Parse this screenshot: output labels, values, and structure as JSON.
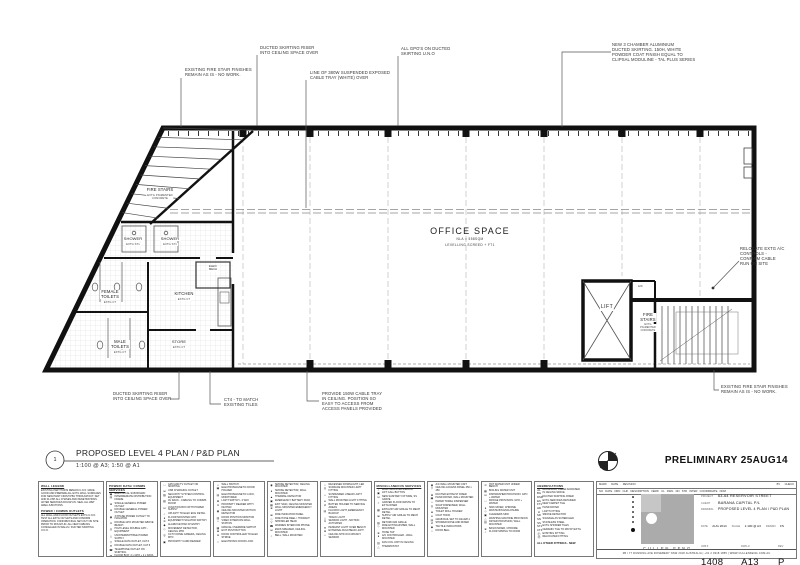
{
  "sheet": {
    "plan_number": "1",
    "plan_title": "PROPOSED LEVEL 4 PLAN / P&D PLAN",
    "plan_scale": "1:100 @ A3;  1:50 @ A1",
    "status_stamp": "PRELIMINARY 25AUG14"
  },
  "rooms": {
    "fire_stairs_left": "FIRE STAIRS",
    "fire_stairs_left_sub": "EXTG  PIGMENTED\nCONCRETE",
    "shower_1": "SHOWER",
    "shower_1_sub": "EXTG  ST1",
    "shower_2": "SHOWER",
    "shower_2_sub": "EXTG  ST1",
    "female_toilets": "FEMALE\nTOILETS",
    "female_toilets_sub": "EXTG  CT",
    "kitchen": "KITCHEN",
    "kitchen_sub": "EXTG  CT",
    "elec_mech": "ELEC/\nMECH",
    "male_toilets": "MALE\nTOILETS",
    "male_toilets_sub": "EXTG  CT",
    "store": "STORE",
    "store_sub": "EXTG  CT",
    "office": "OFFICE SPACE",
    "office_sub1": "NLA = 558SQM",
    "office_sub2": "LEVELLING  SCREED  +  FT1",
    "lift": "LIFT",
    "ac": "A/C",
    "fire_stairs_right": "FIRE\nSTAIRS",
    "fire_stairs_right_sub": "EXTG\nPIGMENTED\nCONCRETE"
  },
  "annotations": {
    "fire_stair_top": "EXISTING FIRE STAIR FINISHES\nREMAIN AS IS - NO WORK.",
    "skirting_riser_top": "DUCTED SKIRTING RISER\nINTO CEILING SPACE OVER",
    "cable_tray_line": "LINE OF 380W SUSPENDED EXPOSED\nCABLE TRAY (WHITE) OVER",
    "gpos": "ALL GPO'S ON DUCTED\nSKIRTING U.N.O",
    "new_skirting": "NEW 3 CHAMBER ALUMINIUM\nDUCTED SKIRTING. 150H, WHITE\nPOWDER COAT FINISH EQUAL TO\nCLIPSAL MODULINE - TAL PLUS SERIES",
    "relocate_ac": "RELOCATE EXTG A/C\nCONTROLS -\nCONFIRM CABLE\nRUN ON SITE",
    "skirting_riser_bottom": "DUCTED SKIRTING RISER\nINTO CEILING SPACE OVER",
    "ct4": "CT4 - TO MATCH\nEXISTING TILES",
    "cable_tray_ceiling": "PROVIDE 150W CABLE TRAY\nIN CEILING. POSITION SO\nEASY TO ACCESS FROM\nACCESS PANELS PROVIDED",
    "fire_stair_bottom": "EXISTING FIRE STAIR FINISHES\nREMAIN AS IS - NO WORK."
  },
  "legend": {
    "wall": {
      "header": "WALL LEGEND",
      "body": "EXISTING PARTITIONS REMAIN U.N.O. MAKE GOOD AND PREPARE ALL EXTG WALL SURFACES FOR NEW PAINT FINISH PB1 THROUGHOUT. SET AND FLUSH ALL CHASES AND PENETRATIONS AFTER SERVICES ROUGH-IN. SEAL ALL WET AREA JUNCTIONS.",
      "sub_header": "POWER / COMMS OUTLETS",
      "sub_body": "ALL WALL AND FLOOR OUTLETS EXTG U.N.O. TEST ALL EXTG OUTLETS AND CONFIRM OPERATION. CONFIRM FINAL SET-OUT ON SITE PRIOR TO ROUGH-IN. ALL NEW CABLING CONCEALED IN WALLS / DUCTED SKIRTING U.N.O."
    },
    "columns": [
      {
        "header": "POWER/ DATA/ COMMS SERVICES",
        "items": [
          {
            "s": "▣",
            "t": "ELECTRICAL SUB BOARD"
          },
          {
            "s": "▤",
            "t": "INTERMEDIATE DISTRIBUTION FRAME"
          },
          {
            "s": "⊕",
            "t": "SINGLE GENERAL POWER OUTLET"
          },
          {
            "s": "⊕",
            "t": "DOUBLE GENERAL POWER OUTLET"
          },
          {
            "s": "◉",
            "t": "3 PHASE POWER OUTLET TO ISOLATOR"
          },
          {
            "s": "⊙",
            "t": "DOUBLE GPO MOUNTED ABOVE BENCH"
          },
          {
            "s": "◎",
            "t": "HIGH LEVEL DOUBLE GPO - EQUIPMENT"
          },
          {
            "s": "△",
            "t": "UNINTERRUPTIBLE POWER SUPPLY"
          },
          {
            "s": "▽",
            "t": "SINGLE DATA OUTLET, CAT 6"
          },
          {
            "s": "▼",
            "t": "DOUBLE DATA OUTLET, CAT 6"
          },
          {
            "s": "☎",
            "t": "TELEPHONE OUTLET ON SKIRTING"
          },
          {
            "s": "▦",
            "t": "FLOOR BOX: 2 x GPO + 2 x DATA"
          }
        ]
      },
      {
        "header": "",
        "items": [
          {
            "s": "□",
            "t": "GPO AND TV OUTLET ON SKIRTING"
          },
          {
            "s": "⊟",
            "t": "USB CHARGING OUTLET"
          },
          {
            "s": "▧",
            "t": "SECURITY SYSTEM CONTROL EQUIPMENT"
          },
          {
            "s": "▨",
            "t": "AV RACK - CABLING TO COMMS ROOM"
          },
          {
            "s": "⊡",
            "t": "JUNCTION BOX WITH POWER SUPPLY"
          },
          {
            "s": "○",
            "t": "UPLIGHT TO ELEC ENG DETAIL"
          },
          {
            "s": "●",
            "t": "FLOOR MOUNTED GPO"
          },
          {
            "s": "⊘",
            "t": "EQUIPMENT ISOLATOR SWITCH"
          },
          {
            "s": "◆",
            "t": "ALARM KEYPAD AT ENTRY"
          },
          {
            "s": "◇",
            "t": "MOVEMENT DETECTOR, CEILING MTD"
          },
          {
            "s": "◎",
            "t": "CCTV DOME CAMERA, CEILING MTD"
          },
          {
            "s": "▣",
            "t": "PROXIMITY CARD READER"
          }
        ]
      },
      {
        "header": "",
        "items": [
          {
            "s": "□",
            "t": "WALL SWITCH"
          },
          {
            "s": "▣",
            "t": "ELECTROMAGNETIC DOOR HOLDER"
          },
          {
            "s": "▤",
            "t": "ELECTROMAGNETIC LOCK, MONITORED"
          },
          {
            "s": "⊠",
            "t": "LIGHT SWITCH - 2 WAY"
          },
          {
            "s": "⊙",
            "t": "PROXIMITY READER WITH KEYPAD"
          },
          {
            "s": "◉",
            "t": "CEILING MOUNTED MOTION DETECTOR"
          },
          {
            "s": "▥",
            "t": "DOOR POSITION MONITOR"
          },
          {
            "s": "□",
            "t": "VIDEO INTERCOM WALL STATION"
          },
          {
            "s": "▦",
            "t": "MANUAL OVERRIDE SWITCH"
          },
          {
            "s": "⊞",
            "t": "EXIT PUSH BUTTON"
          },
          {
            "s": "⊡",
            "t": "DOOR CONTROLLER TO ELEC STRIKE"
          },
          {
            "s": "≈",
            "t": "ELECTRONIC DOOR LOCK"
          }
        ]
      },
      {
        "header": "",
        "items": [
          {
            "s": "◉",
            "t": "SMOKE DETECTOR, CEILING MOUNTED"
          },
          {
            "s": "●",
            "t": "SMOKE DETECTOR, WALL MOUNTED"
          },
          {
            "s": "▲",
            "t": "THERMAL DETECTOR"
          },
          {
            "s": "▣",
            "t": "EMERGENCY BATTERY PACK"
          },
          {
            "s": "▦",
            "t": "EXIT SIGN, CEILING MOUNTED"
          },
          {
            "s": "⊕",
            "t": "WALL MOUNTED EMERGENCY LIGHT"
          },
          {
            "s": "⊞",
            "t": "FIRE INDICATOR PANEL"
          },
          {
            "s": "◇",
            "t": "FIRE HOSE REEL / HYDRANT"
          },
          {
            "s": "▽",
            "t": "SPRINKLER HEAD"
          },
          {
            "s": "☎",
            "t": "WARDEN INTERCOM PHONE"
          },
          {
            "s": "⊟",
            "t": "EWIS SPEAKER, CEILING MOUNTED"
          },
          {
            "s": "○",
            "t": "BELL, WALL MOUNTED"
          }
        ]
      },
      {
        "header": "",
        "items": [
          {
            "s": "○",
            "t": "RECESSED DOWNLIGHT, LED"
          },
          {
            "s": "◎",
            "t": "SURFACE MOUNTED LIGHT FITTING"
          },
          {
            "s": "□",
            "t": "SUSPENDED LINEAR LIGHT FITTING"
          },
          {
            "s": "●",
            "t": "WALL MOUNTED LIGHT FITTING"
          },
          {
            "s": "⊘",
            "t": "BATTEN HOLDER TO SERVICE AREAS"
          },
          {
            "s": "▤",
            "t": "FLUORO LIGHT, EMERGENCY BACKUP"
          },
          {
            "s": "△",
            "t": "TRACK LIGHT"
          },
          {
            "s": "⊙",
            "t": "SENSOR LIGHT - MOTION ACTIVATED"
          },
          {
            "s": "▼",
            "t": "PENDANT LIGHT OVER BENCH"
          },
          {
            "s": "⊕",
            "t": "EXTERNAL BULKHEAD LIGHT"
          },
          {
            "s": "□",
            "t": "CEILING MTD OCCUPANCY SENSOR"
          }
        ]
      },
      {
        "header": "MISCELLANEOUS SERVICES",
        "items": [
          {
            "s": "○",
            "t": "WALL MOUNTED MIRROR"
          },
          {
            "s": "▣",
            "t": "LIFT CALL BUTTON"
          },
          {
            "s": "⊡",
            "t": "NEW SANITARY FIXTURE, SS GRATE"
          },
          {
            "s": "≈",
            "t": "GRATED FLOOR WASTE TO EXTG RISER"
          },
          {
            "s": "▦",
            "t": "EXHAUST AIR GRILLE TO MECH DETAIL"
          },
          {
            "s": "⊞",
            "t": "SUPPLY AIR GRILLE TO MECH DETAIL"
          },
          {
            "s": "▧",
            "t": "RETURN AIR GRILLE"
          },
          {
            "s": "◇",
            "t": "FIRE EXTINGUISHER, WALL MOUNTED"
          },
          {
            "s": "⊕",
            "t": "HOSE TAP"
          },
          {
            "s": "●",
            "t": "A/C CONTROLLER - WALL MOUNTED"
          },
          {
            "s": "▥",
            "t": "FAN COIL UNIT IN CEILING"
          },
          {
            "s": "△",
            "t": "THERMOSTAT"
          }
        ]
      },
      {
        "header": "",
        "items": [
          {
            "s": "◉",
            "t": "A/C WALL MOUNTED UNIT"
          },
          {
            "s": "▽",
            "t": "CEILING ACCESS PANEL 450 x 450"
          },
          {
            "s": "⊠",
            "t": "DUCTED EXHAUST RISER"
          },
          {
            "s": "▣",
            "t": "HAND DRYER, WALL MOUNTED"
          },
          {
            "s": "□",
            "t": "PAPER TOWEL DISPENSER"
          },
          {
            "s": "◎",
            "t": "SOAP DISPENSER, WALL MOUNTED"
          },
          {
            "s": "⊟",
            "t": "TOILET ROLL HOLDER"
          },
          {
            "s": "●",
            "t": "COAT HOOK"
          },
          {
            "s": "▤",
            "t": "GRAB RAIL SET TO AS1428.1"
          },
          {
            "s": "⊘",
            "t": "SHOWER ROSE AND MIXER"
          },
          {
            "s": "◆",
            "t": "TACTILE INDICATORS"
          },
          {
            "s": "○",
            "t": "DOOR BELL"
          }
        ]
      },
      {
        "header": "",
        "items": [
          {
            "s": "⊙",
            "t": "HOT WATER UNIT UNDER BENCH"
          },
          {
            "s": "▦",
            "t": "BOILING WATER UNIT"
          },
          {
            "s": "⊡",
            "t": "DISHWASHER PROVISION: GPO + WATER"
          },
          {
            "s": "□",
            "t": "FRIDGE PROVISION: GPO + WATER"
          },
          {
            "s": "●",
            "t": "SINK MIXER, CHROME"
          },
          {
            "s": "◇",
            "t": "WASTE BIN ENCLOSURE"
          },
          {
            "s": "▣",
            "t": "CLEANERS SINK"
          },
          {
            "s": "△",
            "t": "WASHING MACHINE PROVISION"
          },
          {
            "s": "▥",
            "t": "DRYER PROVISION, WALL MOUNTED"
          },
          {
            "s": "⊕",
            "t": "BASIN MIXER, CHROME"
          },
          {
            "s": "○",
            "t": "FLOOR SPRING TO DOOR"
          }
        ]
      },
      {
        "header": "ABBREVIATIONS",
        "items": [
          {
            "s": "AL",
            "t": "ALUMINIUM, CLEAR ANODISED"
          },
          {
            "s": "BG",
            "t": "IN CEILING SPACE"
          },
          {
            "s": "DSR",
            "t": "DUCTED SKIRTING RISER"
          },
          {
            "s": "ES",
            "t": "EXTG SERVICES RETAINED"
          },
          {
            "s": "FT1",
            "t": "NEW CARPET TILE"
          },
          {
            "s": "HD",
            "t": "HAND DRYER"
          },
          {
            "s": "LI",
            "t": "LIGHT FITTING"
          },
          {
            "s": "SD",
            "t": "SMOKE DETECTOR"
          },
          {
            "s": "SN",
            "t": "SIGNAGE AS SCHEDULED"
          },
          {
            "s": "SS",
            "t": "STAINLESS STEEL"
          },
          {
            "s": "ST1",
            "t": "EXTG SHOWER TILES"
          },
          {
            "s": "CT4",
            "t": "CERAMIC TILE TO MATCH EXTG"
          },
          {
            "s": "Ⓔ",
            "t": "EXISTING FITTING"
          },
          {
            "s": "Ⓡ",
            "t": "RELOCATED FITTING"
          }
        ],
        "footer": "ALL OTHER FITTINGS - NEW"
      }
    ]
  },
  "titleblock": {
    "rev_row1_left": "MARK      DATE      REVISION",
    "rev_row1_right": "BY      CHECK",
    "rev_row2": "NO   DATE   DRN   CHK   DESCRIPTION   VERIF   CL   DWG   DN   STD   INTER   COORDINATE   NOM",
    "project_label": "PROJECT",
    "project": "63-64 RESERVOIR STREET",
    "client_label": "CLIENT",
    "client": "BARANA CAPITAL P/L",
    "drawing_label": "DRAWING",
    "drawing": "PROPOSED LEVEL 4 PLAN / P&D PLAN",
    "date_label": "DATE",
    "date": "AUG 2014",
    "scale_label": "SCALE",
    "scale": "1:100 @ A3",
    "drawn_label": "DRAWN",
    "drawn": "FS",
    "job_label": "JOB #",
    "job": "1408",
    "dwg_label": "DWG #",
    "dwg": "A13",
    "rev_label": "REV",
    "rev": "P",
    "firm": "CULLEN FENG",
    "contact": "3B / 77 DUNNING AVE ROSEBERY NSW 2018 AUSTRALIA   |   +61 2 9318 1855   |   WWW.CULLENFENG.COM.AU"
  }
}
